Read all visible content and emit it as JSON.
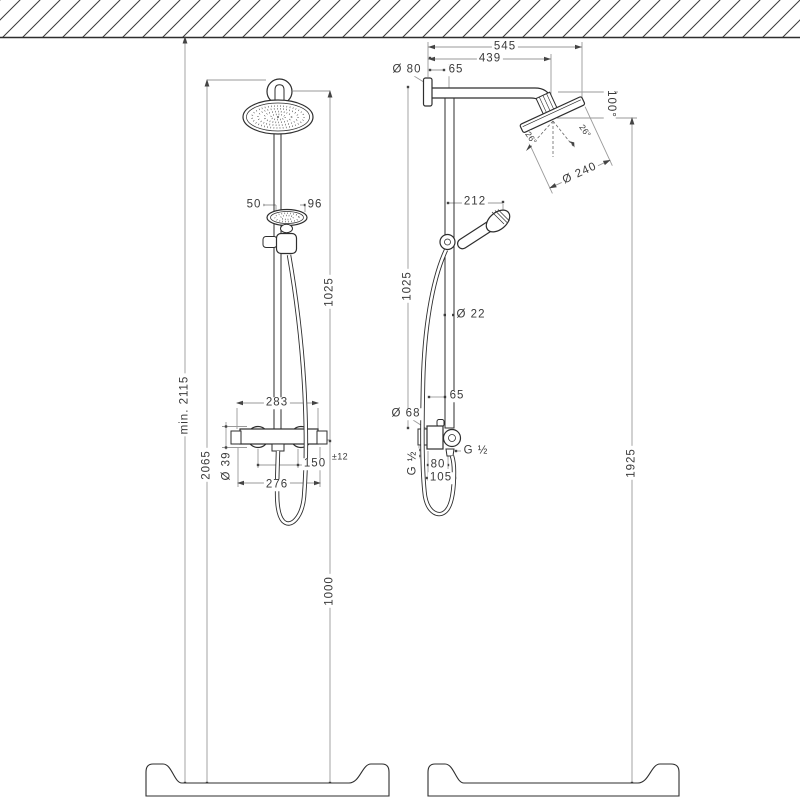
{
  "page": {
    "background": "#ffffff",
    "object_line_color": "#2e2e2e",
    "dimension_line_color": "#9a9a9a",
    "text_color": "#3a3a3a"
  },
  "front_view": {
    "min_ceiling_height": "min. 2115",
    "pipe_top_height": "2065",
    "pipe_upper_length": "1025",
    "valve_to_floor": "1000",
    "handshower_offset": "50",
    "handshower_width": "96",
    "valve_width": "283",
    "handle_diameter": "Ø 39",
    "supply_distance": "150",
    "supply_tolerance": "±12",
    "union_distance": "276"
  },
  "side_view": {
    "reach_total": "545",
    "reach_arm": "439",
    "flange_diameter": "Ø 80",
    "wall_to_pipe": "65",
    "head_drop": "100°",
    "spray_angle_left": "26°",
    "spray_angle_right": "26°",
    "head_diameter": "Ø 240",
    "handshower_offset": "212",
    "pipe_length": "1025",
    "pipe_diameter": "Ø 22",
    "bar_offset": "65",
    "escutcheon_diameter": "Ø 68",
    "thread_wall": "G ½",
    "thread_hose": "G ½",
    "hose_offset_upper": "80",
    "hose_offset_lower": "105",
    "head_to_floor": "1925"
  }
}
